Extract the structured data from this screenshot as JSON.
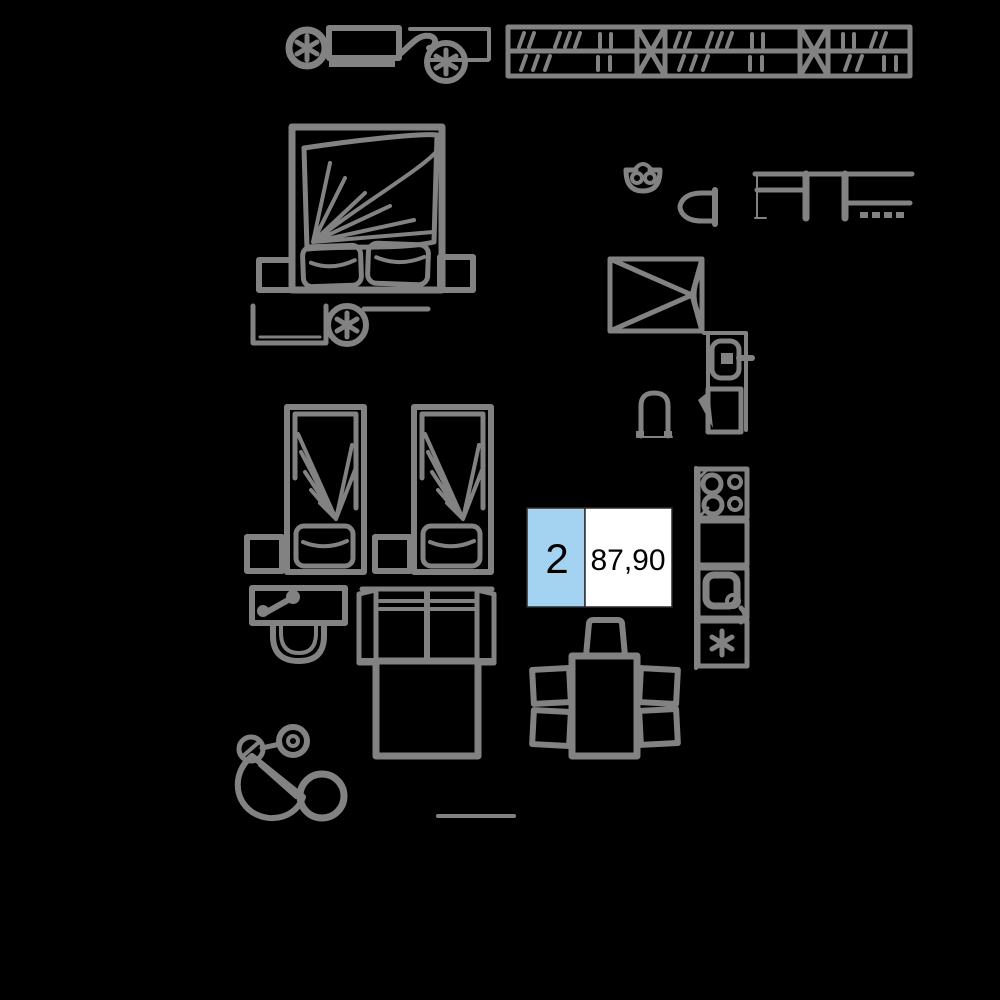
{
  "page": {
    "kind": "apartment-floor-plan-furniture-render",
    "background_description": "black canvas with gray line-art furniture symbols"
  },
  "colors": {
    "background": "#000000",
    "line": "#828282",
    "accent": "#a4d3f2",
    "label_bg": "#ffffff",
    "label_text": "#000000",
    "label_border": "#2b2b2b"
  },
  "unit_label": {
    "rooms": "2",
    "area": "87,90"
  },
  "symbols": [
    "wheeled-sketch-top",
    "wardrobe",
    "kitchen-counter-elevation",
    "sconce",
    "d-fixture",
    "shower-tray",
    "toilet",
    "bath-appliance",
    "stool",
    "cooktop",
    "counter",
    "kitchen-sink",
    "dishwasher",
    "dining-table",
    "chair",
    "double-bed",
    "pillow",
    "nightstand",
    "bench",
    "ceiling-lamp",
    "single-bed",
    "washbasin",
    "sofa-bed",
    "wheeled-sketch-bottom",
    "floor-line"
  ]
}
